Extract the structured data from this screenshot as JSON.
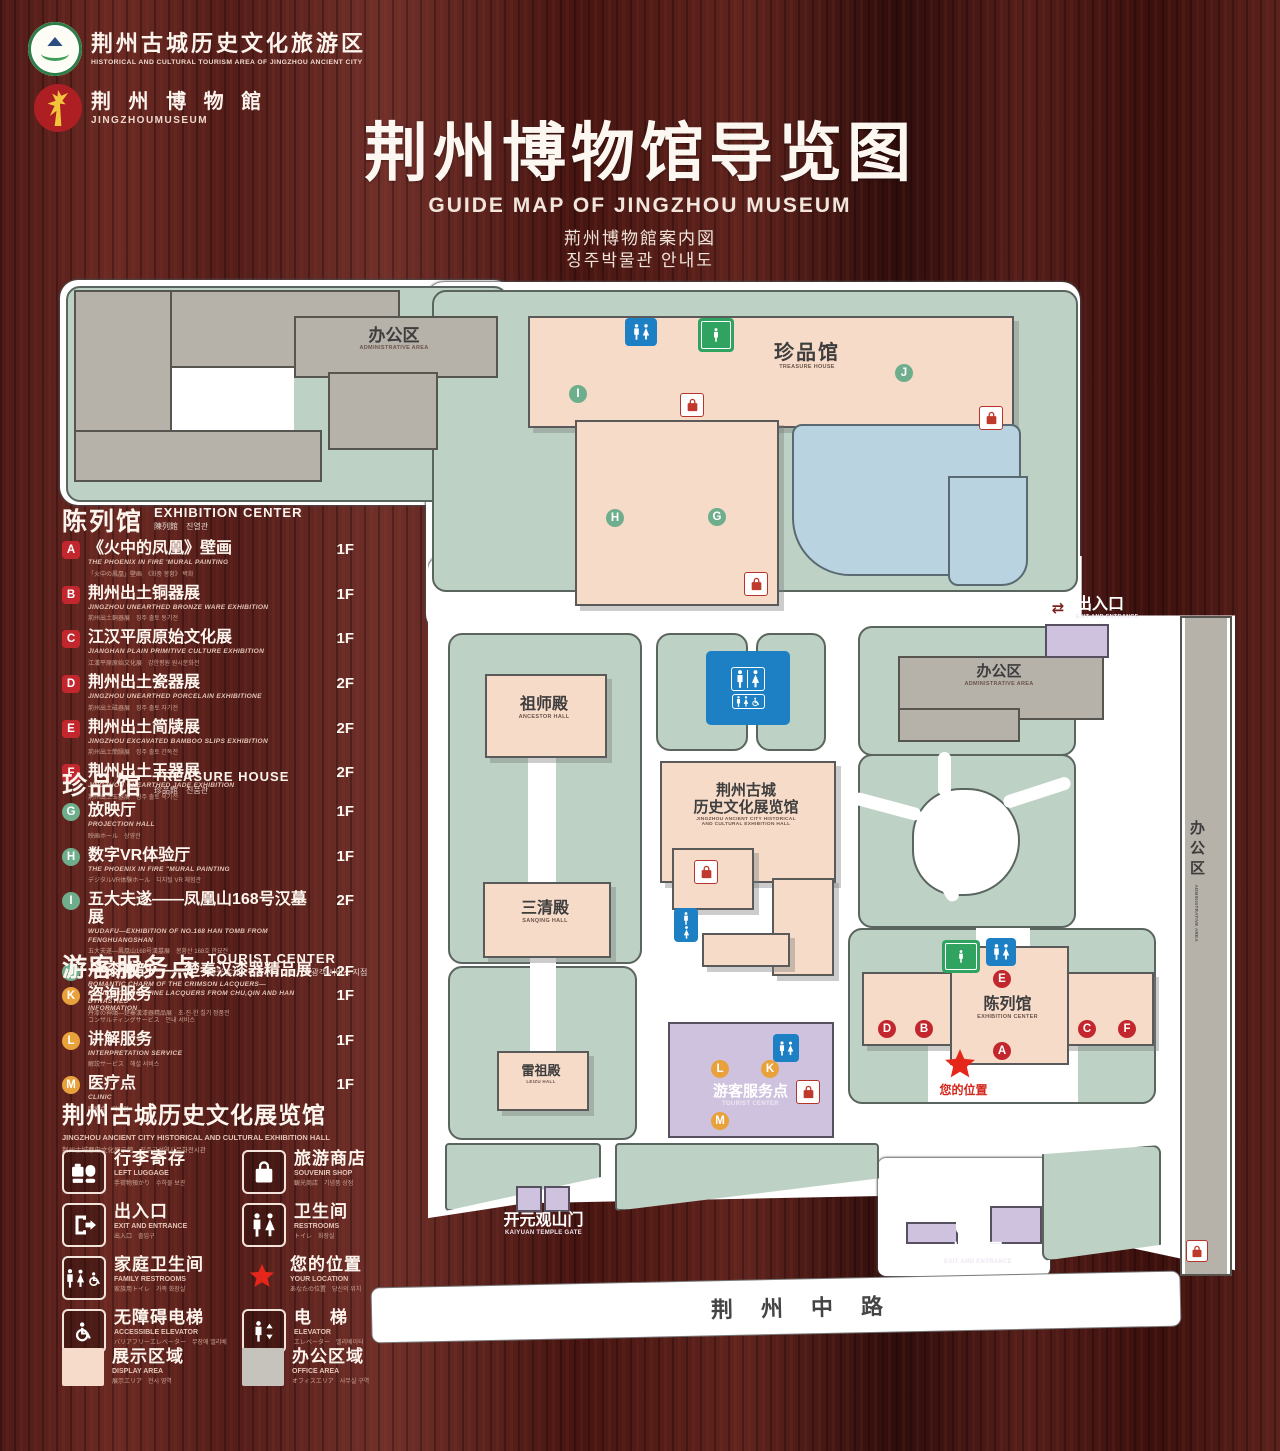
{
  "colors": {
    "wood": "#541d19",
    "path": "#ffffff",
    "campus_green": "#bdd2c5",
    "building_pink": "#f7dbc9",
    "building_gray": "#b6b1a9",
    "pond_blue": "#b9d3e0",
    "purple": "#cec2de",
    "badge_red": "#c3272e",
    "badge_green": "#6fae8c",
    "badge_orange": "#e9a23b",
    "wc_blue": "#1d80c4",
    "elevator_green": "#2fa35f",
    "star_red": "#e5261b"
  },
  "header": {
    "logo_tourism": {
      "cn": "荆州古城历史文化旅游区",
      "en": "HISTORICAL AND CULTURAL TOURISM AREA OF JINGZHOU ANCIENT CITY"
    },
    "logo_museum": {
      "cn": "荆 州 博 物 館",
      "en": "JINGZHOUMUSEUM"
    },
    "title": "荆州博物馆导览图",
    "subtitle_en": "GUIDE MAP OF JINGZHOU MUSEUM",
    "subtitle_ja": "荊州博物館案内図",
    "subtitle_ko": "징주박물관 안내도"
  },
  "legend": {
    "exhibition": {
      "title": "陈列馆",
      "title_en": "EXHIBITION CENTER",
      "title_sub": "陳列館　진열관",
      "items": [
        {
          "letter": "A",
          "cn": "《火中的凤凰》壁画",
          "en": "THE PHOENIX IN FIRE 'MURAL PAINTING",
          "sub": "「火中の鳳凰」壁画　《화중 봉황》 벽화",
          "floor": "1F"
        },
        {
          "letter": "B",
          "cn": "荆州出土铜器展",
          "en": "JINGZHOU UNEARTHED BRONZE WARE EXHIBITION",
          "sub": "荊州出土銅器展　징주 출토 동기전",
          "floor": "1F"
        },
        {
          "letter": "C",
          "cn": "江汉平原原始文化展",
          "en": "JIANGHAN PLAIN PRIMITIVE CULTURE EXHIBITION",
          "sub": "江漢平原原始文化展　강한평원 원시문화전",
          "floor": "1F"
        },
        {
          "letter": "D",
          "cn": "荆州出土瓷器展",
          "en": "JINGZHOU UNEARTHED PORCELAIN EXHIBITIONE",
          "sub": "荊州出土磁器展　징주 출토 자기전",
          "floor": "2F"
        },
        {
          "letter": "E",
          "cn": "荆州出土简牍展",
          "en": "JINGZHOU EXCAVATED BAMBOO SLIPS EXHIBITION",
          "sub": "荊州出土簡牘展　징주 출토 간독전",
          "floor": "2F"
        },
        {
          "letter": "F",
          "cn": "荆州出土玉器展",
          "en": "JINGZHOU UNEARTHED JADE EXHIBITION",
          "sub": "荊州出土玉器展　징주 출토 옥기전",
          "floor": "2F"
        }
      ]
    },
    "treasure": {
      "title": "珍品馆",
      "title_en": "TREASURE HOUSE",
      "title_sub": "珍品館　진품관",
      "items": [
        {
          "letter": "G",
          "cn": "放映厅",
          "en": "PROJECTION HALL",
          "sub": "映画ホール　상영관",
          "floor": "1F"
        },
        {
          "letter": "H",
          "cn": "数字VR体验厅",
          "en": "THE PHOENIX IN FIRE \"MURAL PAINTING",
          "sub": "デジタルVR体験ホール　디지털 VR 체험관",
          "floor": "1F"
        },
        {
          "letter": "I",
          "cn": "五大夫遂——凤凰山168号汉墓展",
          "en": "WUDAFU—EXHIBITION OF NO.168 HAN TOMB FROM FENGHUANGSHAN",
          "sub": "五大夫遂—鳳凰山168号漢墓展　봉황산 168호 한묘전",
          "floor": "2F"
        },
        {
          "letter": "J",
          "cn": "丹漆神韵——楚秦汉漆器精品展",
          "en": "ROMANTIC CHARM OF THE CRIMSON LACQUERS— EXHIBITIONS OF FINE LACQUERS FROM CHU,QIN AND HAN DYNASTIES",
          "sub": "丹漆の神韻—楚秦漢漆器精品展　초·진·한 칠기 정품전",
          "floor": "1-2F"
        }
      ]
    },
    "tourist": {
      "title": "游客服务点",
      "title_en": "TOURIST CENTER",
      "title_sub": "観光客サービスポイント　관광객 서비스 지점",
      "items": [
        {
          "letter": "K",
          "cn": "咨询服务",
          "en": "INFORMATION",
          "sub": "コンサルティングサービス　안내 서비스",
          "floor": "1F"
        },
        {
          "letter": "L",
          "cn": "讲解服务",
          "en": "INTERPRETATION SERVICE",
          "sub": "解説サービス　해설 서비스",
          "floor": "1F"
        },
        {
          "letter": "M",
          "cn": "医疗点",
          "en": "CLINIC",
          "sub": "医療点　의료점",
          "floor": "1F"
        }
      ]
    },
    "hall_note": {
      "cn": "荆州古城历史文化展览馆",
      "en": "JINGZHOU ANCIENT CITY HISTORICAL AND CULTURAL EXHIBITION HALL",
      "sub": "荆州古城歴史文化展示館　징주고성역사문화전시관"
    },
    "facilities": [
      {
        "icon": "left-luggage-icon",
        "cn": "行李寄存",
        "en": "LEFT LUGGAGE",
        "sub": "手荷物預かり　수하물 보관"
      },
      {
        "icon": "souvenir-shop-icon",
        "cn": "旅游商店",
        "en": "SOUVENIR SHOP",
        "sub": "観光商店　기념품 상점"
      },
      {
        "icon": "exit-entrance-icon",
        "cn": "出入口",
        "en": "EXIT AND ENTRANCE",
        "sub": "出入口　출입구"
      },
      {
        "icon": "restrooms-icon",
        "cn": "卫生间",
        "en": "RESTROOMS",
        "sub": "トイレ　화장실"
      },
      {
        "icon": "family-restrooms-icon",
        "cn": "家庭卫生间",
        "en": "FAMILY RESTROOMS",
        "sub": "家族用トイレ　가족 화장실"
      },
      {
        "icon": "your-location-icon",
        "cn": "您的位置",
        "en": "YOUR LOCATION",
        "sub": "あなたの位置　당신의 위치"
      },
      {
        "icon": "accessible-elevator-icon",
        "cn": "无障碍电梯",
        "en": "ACCESSIBLE ELEVATOR",
        "sub": "バリアフリーエレベーター　무장애 엘리베이터"
      },
      {
        "icon": "elevator-icon",
        "cn": "电　梯",
        "en": "ELEVATOR",
        "sub": "エレベーター　엘리베이터"
      }
    ],
    "areas": [
      {
        "cn": "展示区域",
        "en": "DISPLAY AREA",
        "sub": "展示エリア　전시 영역",
        "color": "#f6dbca"
      },
      {
        "cn": "办公区域",
        "en": "OFFICE AREA",
        "sub": "オフィスエリア　사무실 구역",
        "color": "#c6c3bc"
      }
    ]
  },
  "map": {
    "labels": {
      "admin_area_cn": "办公区",
      "admin_area_en": "ADMINISTRATIVE AREA",
      "treasure_cn": "珍品馆",
      "treasure_en": "TREASURE HOUSE",
      "ancestor_cn": "祖师殿",
      "ancestor_en": "ANCESTOR HALL",
      "sanqing_cn": "三清殿",
      "sanqing_en": "SANQING HALL",
      "leizu_cn": "雷祖殿",
      "leizu_en": "LEIZU HALL",
      "exhall_cn1": "荆州古城",
      "exhall_cn2": "历史文化展览馆",
      "exhall_en1": "JINGZHOU ANCIENT CITY HISTORICAL",
      "exhall_en2": "AND CULTURAL EXHIBITION HALL",
      "excenter_cn": "陈列馆",
      "excenter_en": "EXHIBITION CENTER",
      "tourist_cn": "游客服务点",
      "tourist_en": "TOURIST CENTER",
      "gate_cn": "开元观山门",
      "gate_en": "KAIYUAN TEMPLE GATE",
      "exit_cn": "出入口",
      "exit_en": "EXIT AND ENTRANCE",
      "location_cn": "您的位置",
      "road": "荆州中路"
    }
  }
}
